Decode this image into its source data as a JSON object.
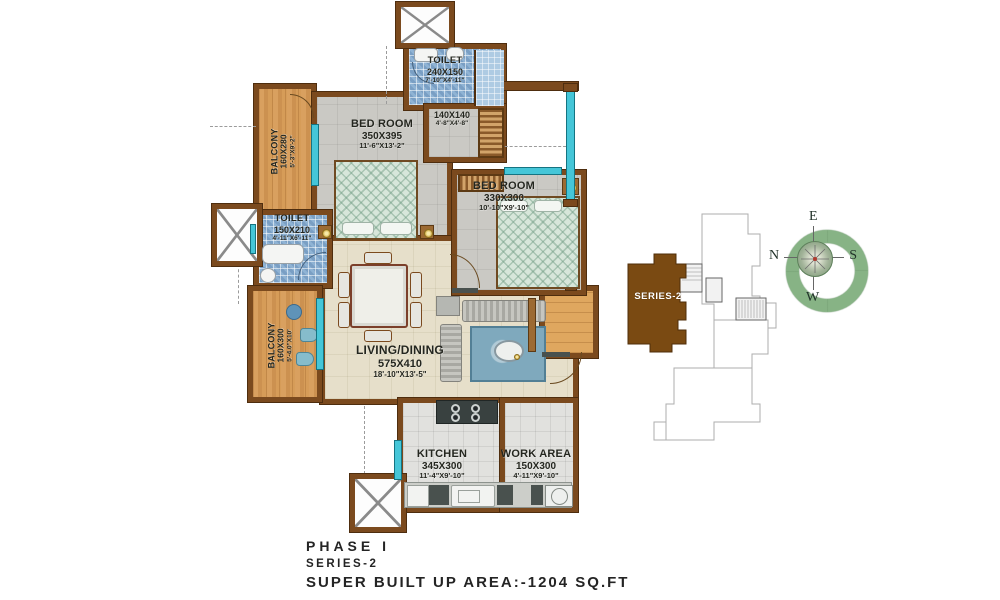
{
  "plan": {
    "rooms": {
      "toilet_top": {
        "name": "TOILET",
        "size": "240X150",
        "ft": "7'-10\"X4'-11\""
      },
      "passage": {
        "size": "140X140",
        "ft": "4'-8\"X4'-8\""
      },
      "bedroom1": {
        "name": "BED ROOM",
        "size": "350X395",
        "ft": "11'-6\"X13'-2\""
      },
      "balcony_top": {
        "name": "BALCONY",
        "size": "160X280",
        "ft": "5'-3\"X9'-2\""
      },
      "toilet_left": {
        "name": "TOILET",
        "size": "150X210",
        "ft": "4'-11\"X6'-11\""
      },
      "bedroom2": {
        "name": "BED ROOM",
        "size": "330X300",
        "ft": "10'-10\"X9'-10\""
      },
      "balcony_bottom": {
        "name": "BALCONY",
        "size": "160X300",
        "ft": "5'-4.0\"X10'"
      },
      "living": {
        "name": "LIVING/DINING",
        "size": "575X410",
        "ft": "18'-10\"X13'-5\""
      },
      "kitchen": {
        "name": "KITCHEN",
        "size": "345X300",
        "ft": "11'-4\"X9'-10\""
      },
      "work_area": {
        "name": "WORK AREA",
        "size": "150X300",
        "ft": "4'-11\"X9'-10\""
      }
    }
  },
  "keyplan": {
    "label": "SERIES-2"
  },
  "compass": {
    "top": "E",
    "left": "N",
    "right": "S",
    "bottom": "W"
  },
  "footer": {
    "line1": "PHASE I",
    "line2": "SERIES-2",
    "line3": "SUPER BUILT UP AREA:-1204 SQ.FT"
  },
  "colors": {
    "wall": "#7b4a1e",
    "window": "#45c6d8",
    "keyplan_highlight": "#7a4a12",
    "compass_green": "#87b385"
  }
}
